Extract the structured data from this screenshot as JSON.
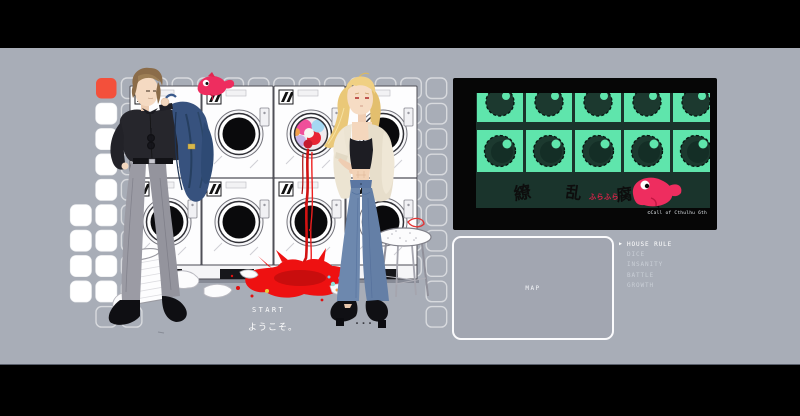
{
  "scene": {
    "background_color": "#a8adb7",
    "letterbox_color": "#000000",
    "accent_square_color": "#f3503b",
    "fish_color": "#ee2d5f",
    "blood_color": "#ee1111"
  },
  "splash": {
    "start_label": "START",
    "welcome_text": "ようこそ。",
    "ellipsis": "..."
  },
  "title_screen": {
    "kanji_left": "繚乱",
    "red_script": "ふらふら",
    "kanji_right": "腐蝕",
    "copyright": "©Call of Cthulhu 6th",
    "bg_color": "#1a342c",
    "tile_color": "#5fe5ac",
    "red_text_color": "#e4214a"
  },
  "map_panel": {
    "label": "MAP"
  },
  "menu": {
    "cursor": "▶",
    "items": [
      {
        "label": "HOUSE RULE",
        "active": true
      },
      {
        "label": "DICE",
        "active": false
      },
      {
        "label": "INSANITY",
        "active": false
      },
      {
        "label": "BATTLE",
        "active": false
      },
      {
        "label": "GROWTH",
        "active": false
      }
    ]
  }
}
